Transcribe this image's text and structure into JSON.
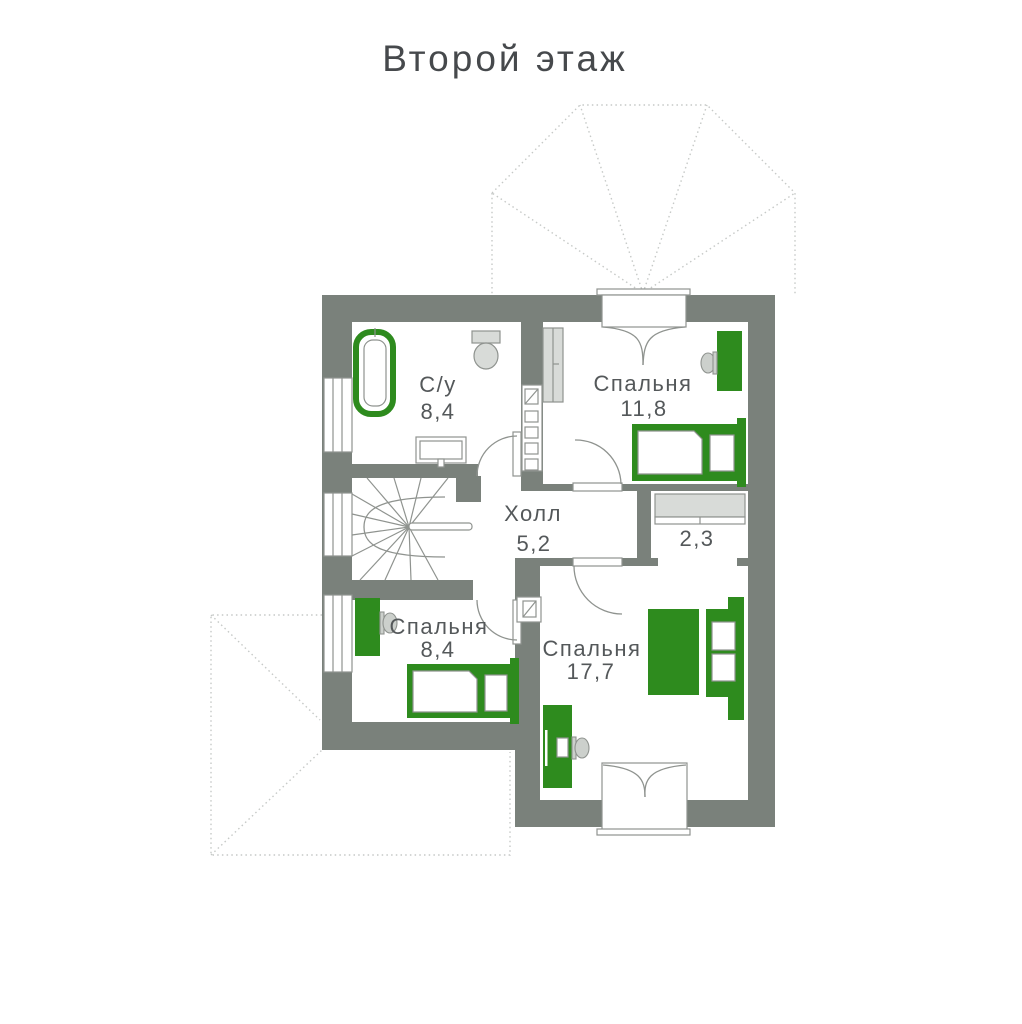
{
  "title": "Второй этаж",
  "plan": {
    "rooms": [
      {
        "id": "bathroom",
        "label": "С/у",
        "area": "8,4",
        "fixtures": [
          "bathtub",
          "toilet",
          "sink"
        ]
      },
      {
        "id": "bedroom-top-right",
        "label": "Спальня",
        "area": "11,8",
        "fixtures": [
          "wardrobe",
          "desk",
          "chair",
          "single-bed",
          "window"
        ]
      },
      {
        "id": "hall",
        "label": "Холл",
        "area": "5,2",
        "fixtures": [
          "winder-staircase",
          "vent-shaft"
        ]
      },
      {
        "id": "closet",
        "label": "",
        "area": "2,3",
        "fixtures": [
          "shelf"
        ]
      },
      {
        "id": "bedroom-bottom-left",
        "label": "Спальня",
        "area": "8,4",
        "fixtures": [
          "desk",
          "chair",
          "single-bed"
        ]
      },
      {
        "id": "bedroom-bottom-right",
        "label": "Спальня",
        "area": "17,7",
        "fixtures": [
          "double-bed",
          "nightstands",
          "desk",
          "chair",
          "window"
        ]
      }
    ],
    "colors": {
      "wall": "#7a817b",
      "furniture_green": "#2e8b1e",
      "fixture_gray": "#d8dbd8",
      "line": "#8f938f",
      "roof_dashed": "#c6c9c7",
      "label_text": "#54585a",
      "title_text": "#46494c"
    }
  }
}
